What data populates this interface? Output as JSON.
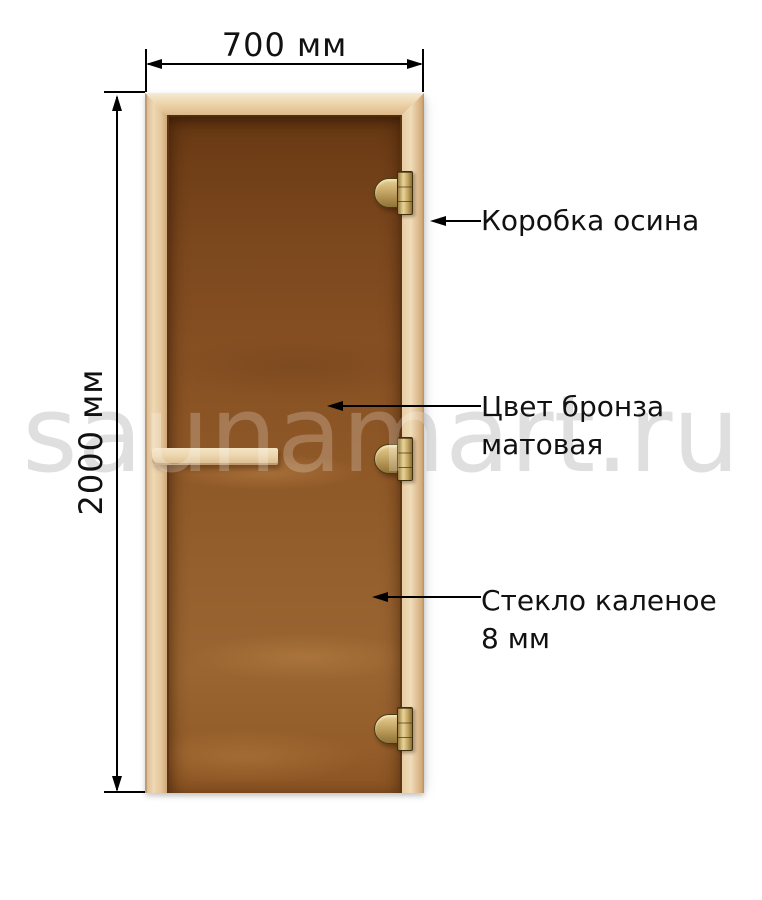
{
  "watermark": {
    "text": "saunamart.ru"
  },
  "dimensions": {
    "width_label": "700 мм",
    "height_label": "2000 мм"
  },
  "callouts": {
    "frame": {
      "line1": "Коробка осина"
    },
    "color": {
      "line1": "Цвет бронза",
      "line2": "матовая"
    },
    "glass": {
      "line1": "Стекло каленое",
      "line2": "8 мм"
    }
  },
  "colors": {
    "frame_wood_light": "#eed8b4",
    "frame_wood_dark": "#cfa878",
    "glass_bronze": "#8a5426",
    "hinge_brass": "#c4a560",
    "annotation_text": "#111111",
    "watermark_gray": "#d6d6d6",
    "background": "#ffffff"
  }
}
